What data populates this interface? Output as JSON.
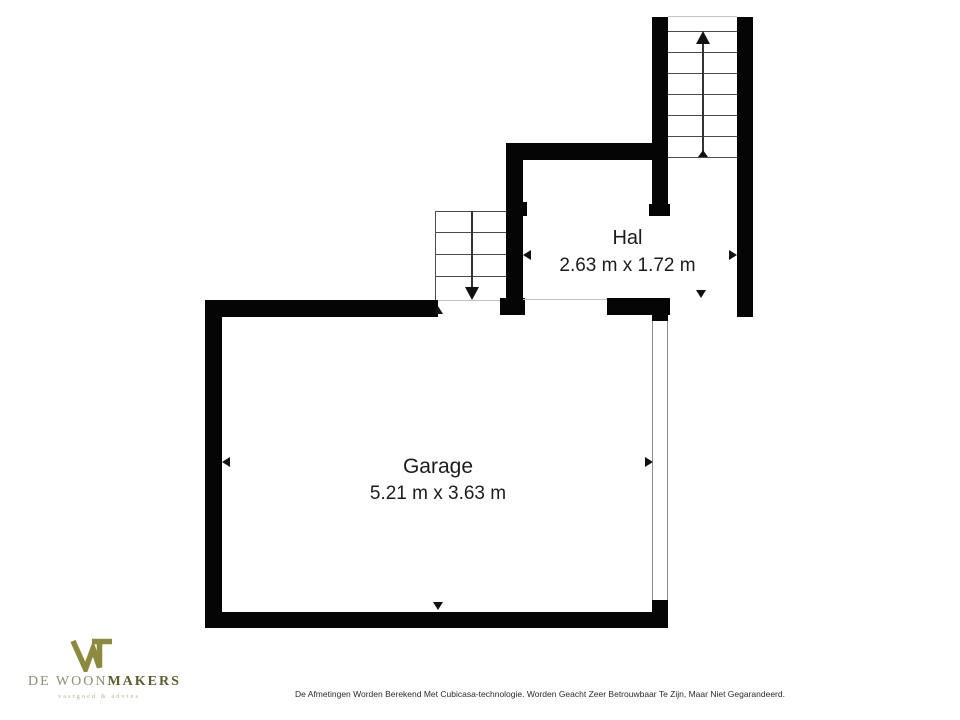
{
  "plan": {
    "rooms": [
      {
        "id": "hal",
        "name": "Hal",
        "dimensions": "2.63 m x 1.72 m"
      },
      {
        "id": "garage",
        "name": "Garage",
        "dimensions": "5.21 m x 3.63 m"
      }
    ],
    "wall_color": "#050505",
    "floor_color": "#ffffff"
  },
  "icons": {
    "stairs_up_arrow": "▲",
    "stairs_down_arrow": "▼",
    "dimension_arrow_left": "◄",
    "dimension_arrow_right": "►",
    "dimension_arrow_up": "▲",
    "dimension_arrow_down": "▼"
  },
  "logo": {
    "brand_prefix": "DE WOON",
    "brand_suffix": "MAKERS",
    "tagline": "vastgoed & advies",
    "mark_color": "#8b8a3e",
    "prefix_color": "#8f8e76",
    "suffix_color": "#5e5d2c",
    "tagline_color": "#b6b593"
  },
  "footer": {
    "disclaimer": "De Afmetingen Worden Berekend Met Cubicasa-technologie. Worden Geacht Zeer Betrouwbaar Te Zijn, Maar Niet Gegarandeerd."
  }
}
